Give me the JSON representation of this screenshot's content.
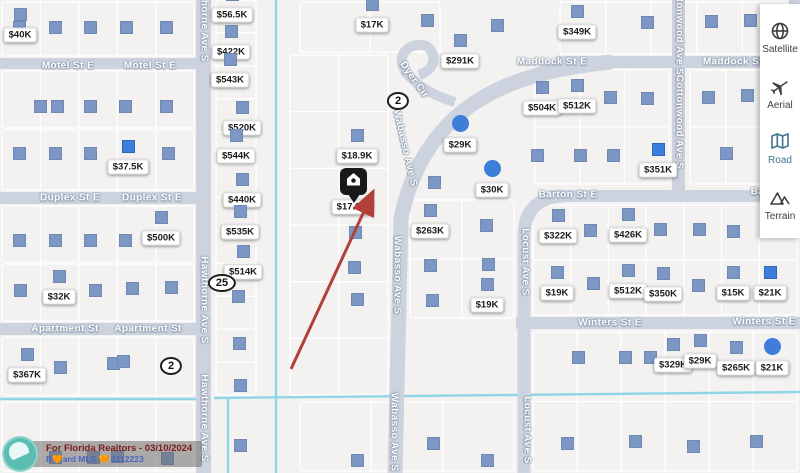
{
  "colors": {
    "map_bg": "#f3f2f0",
    "road": "#ccd3de",
    "water": "#8ed5e8",
    "parcel_line": "#ffffff",
    "marker_square": "#7d97c5",
    "marker_selected": "#3d7edb",
    "pin": "#191919",
    "arrow": "#b2403a",
    "sidebar_selected": "#41738c"
  },
  "sidebar": {
    "items": [
      {
        "label": "Satellite",
        "icon": "satellite-globe-icon",
        "selected": false
      },
      {
        "label": "Aerial",
        "icon": "aerial-plane-icon",
        "selected": false
      },
      {
        "label": "Road",
        "icon": "road-map-icon",
        "selected": true
      },
      {
        "label": "Terrain",
        "icon": "terrain-mountain-icon",
        "selected": false
      }
    ]
  },
  "watermark": {
    "line1": "For Florida Realtors - 03/10/2024",
    "line2": "B🧡ard MLS 🧡 1112223"
  },
  "map": {
    "roads": [
      [
        0,
        58,
        196,
        11
      ],
      [
        0,
        192,
        196,
        12
      ],
      [
        0,
        323,
        196,
        12
      ],
      [
        556,
        56,
        244,
        12
      ],
      [
        550,
        190,
        250,
        12
      ],
      [
        516,
        317,
        284,
        12
      ],
      [
        196,
        0,
        15,
        473
      ],
      [
        672,
        0,
        13,
        196
      ],
      [
        789,
        0,
        11,
        62
      ]
    ],
    "road_paths": [
      "M 612,62 C 505,72 424,108 401,218 L 395,473",
      "M 455,102 Q 424,93 407,74 Q 395,57 410,47 Q 428,40 433,55 Q 436,69 419,75",
      "M 562,196 Q 527,198 524,232 L 524,473"
    ],
    "road_path_widths": [
      15,
      10,
      13
    ],
    "canal_paths": [
      "M 276,0 L 276,473",
      "M 0,399 L 196,399",
      "M 214,398 L 800,392",
      "M 228,398 L 228,473"
    ],
    "street_labels": [
      {
        "text": "Motel St E",
        "x": 68,
        "y": 66,
        "rot": 0
      },
      {
        "text": "Motel St E",
        "x": 150,
        "y": 66,
        "rot": 0
      },
      {
        "text": "Duplex St E",
        "x": 70,
        "y": 198,
        "rot": 0
      },
      {
        "text": "Duplex St E",
        "x": 152,
        "y": 198,
        "rot": 0
      },
      {
        "text": "Apartment St",
        "x": 65,
        "y": 329,
        "rot": 0
      },
      {
        "text": "Apartment St",
        "x": 148,
        "y": 329,
        "rot": 0
      },
      {
        "text": "Maddock St E",
        "x": 552,
        "y": 62,
        "rot": 0
      },
      {
        "text": "Maddock St E",
        "x": 738,
        "y": 62,
        "rot": 0
      },
      {
        "text": "Barton St E",
        "x": 568,
        "y": 195,
        "rot": 0
      },
      {
        "text": "Barton St E",
        "x": 780,
        "y": 192,
        "rot": 0
      },
      {
        "text": "Winters St E",
        "x": 610,
        "y": 323,
        "rot": 0
      },
      {
        "text": "Winters St E",
        "x": 764,
        "y": 322,
        "rot": 0
      },
      {
        "text": "Hawthorne Ave S",
        "x": 204,
        "y": 18,
        "rot": 90
      },
      {
        "text": "Hawthorne Ave S",
        "x": 204,
        "y": 300,
        "rot": 90
      },
      {
        "text": "Hawthorne Ave S",
        "x": 204,
        "y": 418,
        "rot": 90
      },
      {
        "text": "Wabasso Ave S",
        "x": 405,
        "y": 148,
        "rot": 77
      },
      {
        "text": "Wabasso Ave S",
        "x": 397,
        "y": 275,
        "rot": 90
      },
      {
        "text": "Wabasso Ave S",
        "x": 394,
        "y": 432,
        "rot": 90
      },
      {
        "text": "Dyer Cir",
        "x": 414,
        "y": 80,
        "rot": 55
      },
      {
        "text": "Cottonwood Ave S",
        "x": 679,
        "y": 28,
        "rot": 90
      },
      {
        "text": "Cottonwood Ave S",
        "x": 679,
        "y": 122,
        "rot": 90
      },
      {
        "text": "Locust Ave S",
        "x": 525,
        "y": 262,
        "rot": 90
      },
      {
        "text": "Locust Ave S",
        "x": 527,
        "y": 430,
        "rot": 90
      }
    ],
    "route_markers": [
      {
        "text": "2",
        "x": 398,
        "y": 101
      },
      {
        "text": "2",
        "x": 171,
        "y": 366
      },
      {
        "text": "25",
        "x": 222,
        "y": 283
      }
    ],
    "price_markers": [
      {
        "label": "$40K",
        "x": 20,
        "y": 35,
        "shape": "square"
      },
      {
        "label": "$37.5K",
        "x": 128,
        "y": 167,
        "shape": "square",
        "bright": true
      },
      {
        "label": "$32K",
        "x": 59,
        "y": 297,
        "shape": "square"
      },
      {
        "label": "$367K",
        "x": 27,
        "y": 375,
        "shape": "square"
      },
      {
        "label": "$500K",
        "x": 161,
        "y": 238,
        "shape": "square"
      },
      {
        "label": "$56.5K",
        "x": 232,
        "y": 15,
        "shape": "square"
      },
      {
        "label": "$422K",
        "x": 231,
        "y": 52,
        "shape": "square"
      },
      {
        "label": "$543K",
        "x": 230,
        "y": 80,
        "shape": "square"
      },
      {
        "label": "$520K",
        "x": 242,
        "y": 128,
        "shape": "square"
      },
      {
        "label": "$544K",
        "x": 236,
        "y": 156,
        "shape": "square"
      },
      {
        "label": "$440K",
        "x": 242,
        "y": 200,
        "shape": "square"
      },
      {
        "label": "$535K",
        "x": 240,
        "y": 232,
        "shape": "square"
      },
      {
        "label": "$514K",
        "x": 243,
        "y": 272,
        "shape": "square"
      },
      {
        "label": "$17K",
        "x": 372,
        "y": 25,
        "shape": "square"
      },
      {
        "label": "$18.9K",
        "x": 357,
        "y": 156,
        "shape": "square"
      },
      {
        "label": "$17.9K",
        "x": 352,
        "y": 207,
        "shape": "none"
      },
      {
        "label": "$263K",
        "x": 430,
        "y": 231,
        "shape": "square"
      },
      {
        "label": "$291K",
        "x": 460,
        "y": 61,
        "shape": "square"
      },
      {
        "label": "$29K",
        "x": 460,
        "y": 145,
        "shape": "circle"
      },
      {
        "label": "$30K",
        "x": 492,
        "y": 190,
        "shape": "circle"
      },
      {
        "label": "$504K",
        "x": 542,
        "y": 108,
        "shape": "square"
      },
      {
        "label": "$512K",
        "x": 577,
        "y": 106,
        "shape": "square"
      },
      {
        "label": "$349K",
        "x": 577,
        "y": 32,
        "shape": "square"
      },
      {
        "label": "$351K",
        "x": 658,
        "y": 170,
        "shape": "square",
        "bright": true
      },
      {
        "label": "$322K",
        "x": 558,
        "y": 236,
        "shape": "square"
      },
      {
        "label": "$426K",
        "x": 628,
        "y": 235,
        "shape": "square"
      },
      {
        "label": "$19K",
        "x": 557,
        "y": 293,
        "shape": "square"
      },
      {
        "label": "$512K",
        "x": 628,
        "y": 291,
        "shape": "square"
      },
      {
        "label": "$350K",
        "x": 663,
        "y": 294,
        "shape": "square"
      },
      {
        "label": "$15K",
        "x": 733,
        "y": 293,
        "shape": "square"
      },
      {
        "label": "$21K",
        "x": 770,
        "y": 293,
        "shape": "square",
        "bright": true
      },
      {
        "label": "$19K",
        "x": 487,
        "y": 305,
        "shape": "square"
      },
      {
        "label": "$329K",
        "x": 673,
        "y": 365,
        "shape": "square"
      },
      {
        "label": "$29K",
        "x": 700,
        "y": 361,
        "shape": "square"
      },
      {
        "label": "$265K",
        "x": 736,
        "y": 368,
        "shape": "square"
      },
      {
        "label": "$21K",
        "x": 772,
        "y": 368,
        "shape": "circle"
      }
    ],
    "squares": [
      [
        19,
        27
      ],
      [
        55,
        27
      ],
      [
        90,
        27
      ],
      [
        126,
        27
      ],
      [
        166,
        27
      ],
      [
        40,
        106
      ],
      [
        57,
        106
      ],
      [
        90,
        106
      ],
      [
        125,
        106
      ],
      [
        166,
        106
      ],
      [
        19,
        153
      ],
      [
        55,
        153
      ],
      [
        90,
        153
      ],
      [
        168,
        153
      ],
      [
        19,
        240
      ],
      [
        55,
        240
      ],
      [
        90,
        240
      ],
      [
        125,
        240
      ],
      [
        20,
        290
      ],
      [
        95,
        290
      ],
      [
        132,
        288
      ],
      [
        171,
        287
      ],
      [
        60,
        367
      ],
      [
        113,
        363
      ],
      [
        123,
        361
      ],
      [
        238,
        296
      ],
      [
        239,
        343
      ],
      [
        240,
        385
      ],
      [
        240,
        445
      ],
      [
        427,
        20
      ],
      [
        497,
        25
      ],
      [
        647,
        22
      ],
      [
        711,
        21
      ],
      [
        750,
        20
      ],
      [
        610,
        97
      ],
      [
        647,
        98
      ],
      [
        708,
        97
      ],
      [
        747,
        95
      ],
      [
        537,
        155
      ],
      [
        580,
        155
      ],
      [
        613,
        155
      ],
      [
        726,
        153
      ],
      [
        355,
        232
      ],
      [
        354,
        267
      ],
      [
        357,
        299
      ],
      [
        434,
        182
      ],
      [
        430,
        265
      ],
      [
        432,
        300
      ],
      [
        486,
        225
      ],
      [
        488,
        264
      ],
      [
        590,
        230
      ],
      [
        660,
        229
      ],
      [
        699,
        229
      ],
      [
        733,
        231
      ],
      [
        593,
        283
      ],
      [
        698,
        285
      ],
      [
        578,
        357
      ],
      [
        625,
        357
      ],
      [
        650,
        357
      ],
      [
        357,
        460
      ],
      [
        433,
        443
      ],
      [
        487,
        460
      ],
      [
        567,
        443
      ],
      [
        635,
        441
      ],
      [
        693,
        446
      ],
      [
        756,
        441
      ],
      [
        55,
        457
      ],
      [
        93,
        457
      ],
      [
        117,
        456
      ],
      [
        167,
        458
      ]
    ],
    "parcel_blocks": [
      [
        2,
        2,
        192,
        54,
        5,
        1
      ],
      [
        2,
        71,
        192,
        57,
        5,
        1
      ],
      [
        2,
        130,
        192,
        60,
        5,
        1
      ],
      [
        2,
        206,
        192,
        56,
        5,
        1
      ],
      [
        2,
        264,
        192,
        57,
        5,
        1
      ],
      [
        2,
        337,
        192,
        58,
        5,
        1
      ],
      [
        2,
        402,
        192,
        69,
        5,
        1
      ],
      [
        216,
        0,
        40,
        395,
        1,
        12
      ],
      [
        290,
        55,
        98,
        340,
        2,
        6
      ],
      [
        410,
        200,
        104,
        118,
        2,
        2
      ],
      [
        533,
        205,
        264,
        110,
        7,
        2
      ],
      [
        533,
        332,
        264,
        139,
        6,
        2
      ],
      [
        535,
        70,
        134,
        114,
        3,
        2
      ],
      [
        690,
        70,
        107,
        114,
        3,
        2
      ],
      [
        560,
        2,
        228,
        52,
        5,
        1
      ],
      [
        300,
        2,
        140,
        50,
        2,
        1
      ],
      [
        300,
        402,
        214,
        69,
        3,
        1
      ]
    ],
    "pin": {
      "x": 353,
      "y": 184
    },
    "arrow": {
      "x1": 291,
      "y1": 369,
      "x2": 372,
      "y2": 194
    }
  }
}
